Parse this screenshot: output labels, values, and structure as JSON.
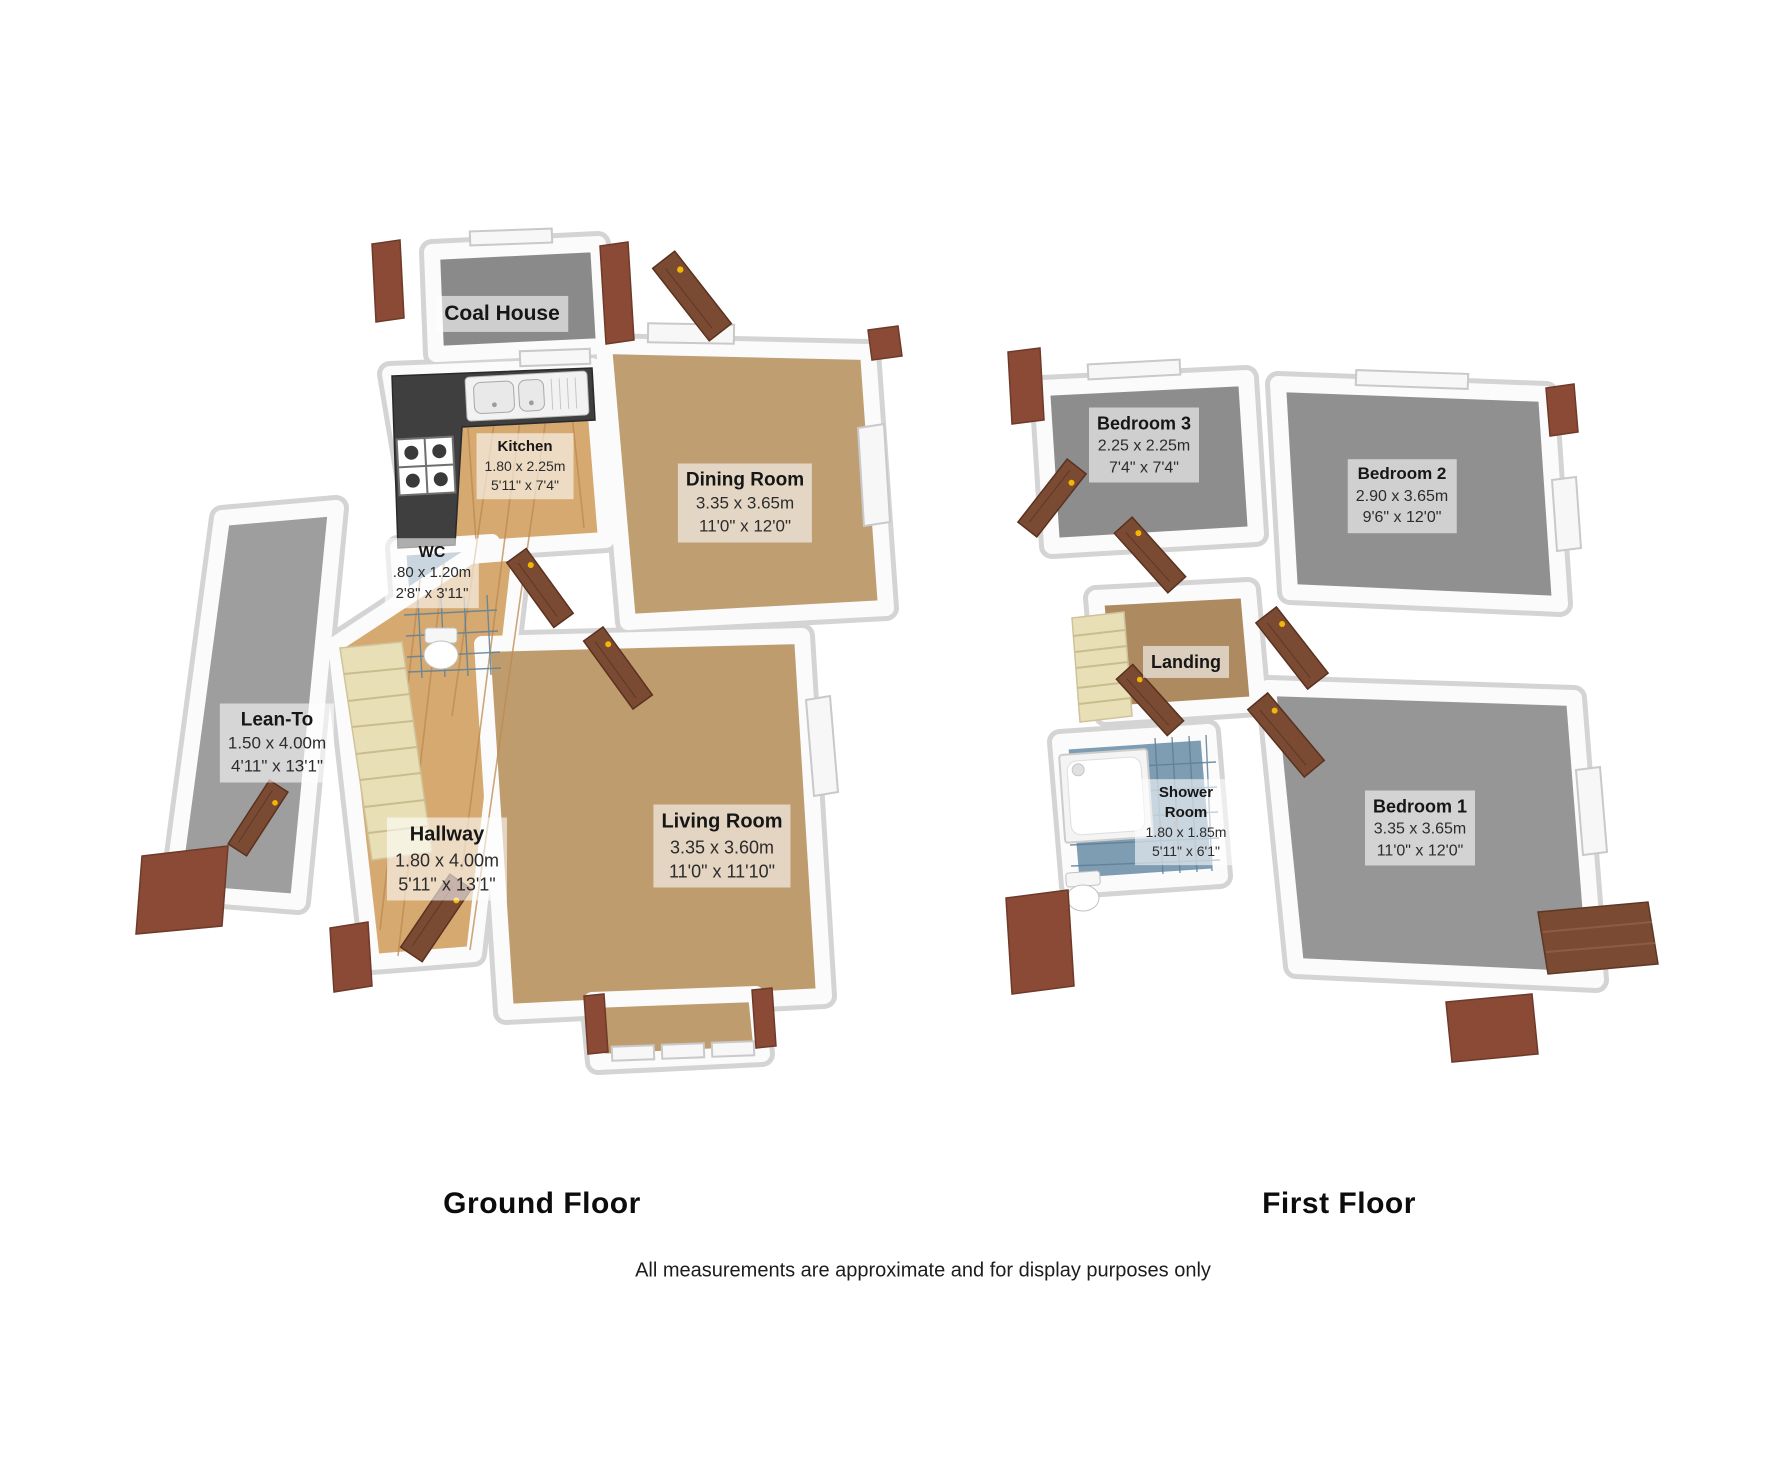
{
  "ground_floor": {
    "title": "Ground Floor",
    "rooms": [
      {
        "name": "Coal House",
        "metric": "",
        "imperial": ""
      },
      {
        "name": "Kitchen",
        "metric": "1.80 x 2.25m",
        "imperial": "5'11\" x 7'4\""
      },
      {
        "name": "Dining Room",
        "metric": "3.35 x 3.65m",
        "imperial": "11'0\" x 12'0\""
      },
      {
        "name": "WC",
        "metric": ".80 x 1.20m",
        "imperial": "2'8\" x 3'11\""
      },
      {
        "name": "Lean-To",
        "metric": "1.50 x 4.00m",
        "imperial": "4'11\" x 13'1\""
      },
      {
        "name": "Hallway",
        "metric": "1.80 x 4.00m",
        "imperial": "5'11\" x 13'1\""
      },
      {
        "name": "Living Room",
        "metric": "3.35 x 3.60m",
        "imperial": "11'0\" x 11'10\""
      }
    ]
  },
  "first_floor": {
    "title": "First Floor",
    "rooms": [
      {
        "name": "Bedroom 3",
        "metric": "2.25 x 2.25m",
        "imperial": "7'4\" x 7'4\""
      },
      {
        "name": "Bedroom 2",
        "metric": "2.90 x 3.65m",
        "imperial": "9'6\" x 12'0\""
      },
      {
        "name": "Landing",
        "metric": "",
        "imperial": ""
      },
      {
        "name": "Shower Room",
        "metric": "1.80 x 1.85m",
        "imperial": "5'11\" x 6'1\""
      },
      {
        "name": "Bedroom 1",
        "metric": "3.35 x 3.65m",
        "imperial": "11'0\" x 12'0\""
      }
    ]
  },
  "footer": {
    "disclaimer": "All measurements are approximate and for display purposes only"
  },
  "colors": {
    "carpet": "#bf9e72",
    "wood_floor": "#d6a970",
    "tile_blue": "#7e9cb2",
    "stairs_cream": "#e9dfb6",
    "bedroom_gray": "#929292",
    "brick": "#8a4a36",
    "door_wood": "#7b4a33",
    "granite": "#3f3f3f"
  }
}
